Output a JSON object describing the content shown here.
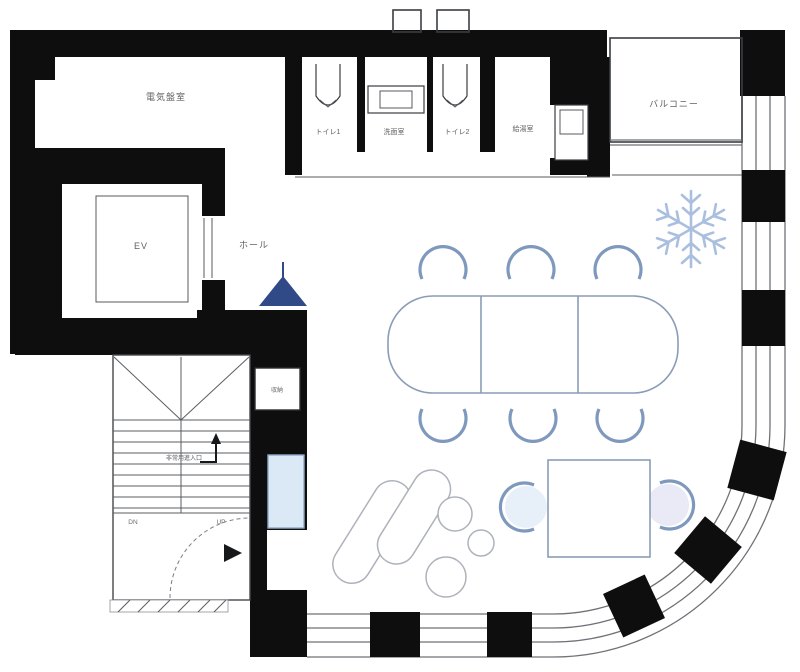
{
  "plan": {
    "type": "architectural-floor-plan",
    "rooms": {
      "electrical": "電気盤室",
      "toilet1": "トイレ1",
      "washroom": "洗面室",
      "toilet2": "トイレ2",
      "kitchenette": "給湯室",
      "balcony": "バルコニー",
      "elevator": "EV",
      "hall": "ホール",
      "storage": "収納"
    },
    "stairs": {
      "down": "DN",
      "up": "UP",
      "emergency": "非常用進入口"
    },
    "colors": {
      "wall": "#0e0e0e",
      "furniture_stroke": "#7e99bd",
      "sofa_stroke": "#aeb2ba",
      "snowflake": "#a3badd",
      "umbrella": "#2f4a86",
      "counter_fill": "#dbe8f5",
      "background": "#ffffff"
    }
  }
}
